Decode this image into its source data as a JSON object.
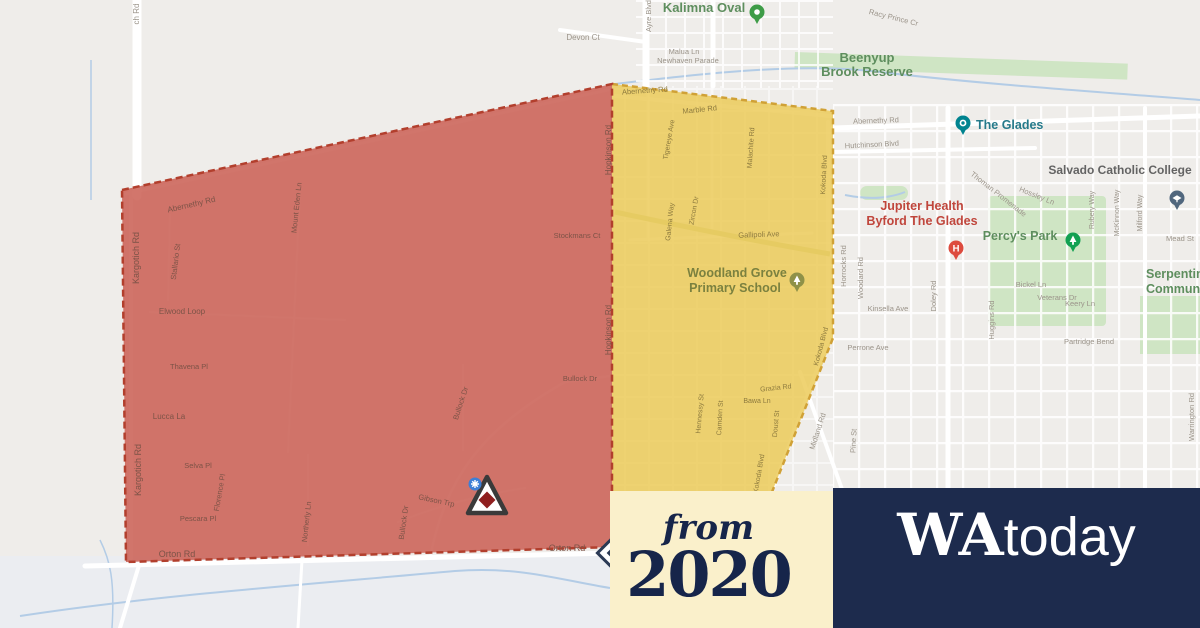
{
  "page": {
    "background": "#efedea"
  },
  "branding": {
    "from_label": "from",
    "year": "2020",
    "outlet_serif": "WA",
    "outlet_sans": "today",
    "badge_bg": "#faf0cb",
    "brand_bg": "#1d2b4d",
    "brand_text_navy": "#16254a"
  },
  "zones": {
    "red": {
      "label": "emergency-warning-zone",
      "fill": "rgba(201,92,80,0.84)",
      "border": "#b23f2d"
    },
    "yellow": {
      "label": "watch-and-act-zone",
      "fill": "rgba(236,201,84,0.82)",
      "border": "#d0a136"
    }
  },
  "map": {
    "labels": [
      {
        "t": "ch Rd",
        "x": 139,
        "y": 14,
        "r": -90,
        "s": 8
      },
      {
        "t": "Devon Ct",
        "x": 583,
        "y": 40,
        "s": 8
      },
      {
        "t": "Malua Ln",
        "x": 684,
        "y": 54,
        "s": 7.5
      },
      {
        "t": "Newhaven Parade",
        "x": 688,
        "y": 63,
        "s": 7.5
      },
      {
        "t": "Racy Prince Cr",
        "x": 893,
        "y": 20,
        "r": 14,
        "s": 7.5
      },
      {
        "t": "Ayre Blvd",
        "x": 651,
        "y": 16,
        "r": -90,
        "s": 7.5
      },
      {
        "t": "Abernethy Rd",
        "x": 876,
        "y": 123,
        "r": -2,
        "s": 7.5
      },
      {
        "t": "Hutchinson Blvd",
        "x": 872,
        "y": 147,
        "r": -3,
        "s": 7.5
      },
      {
        "t": "Thoman Promenade",
        "x": 997,
        "y": 196,
        "r": 38,
        "s": 7.5
      },
      {
        "t": "Hossley Ln",
        "x": 1036,
        "y": 198,
        "r": 22,
        "s": 7.5
      },
      {
        "t": "Mead St",
        "x": 1180,
        "y": 241,
        "s": 7.5
      },
      {
        "t": "Bickel Ln",
        "x": 1031,
        "y": 287,
        "s": 7.5
      },
      {
        "t": "Veterans Dr",
        "x": 1057,
        "y": 300,
        "s": 7.5
      },
      {
        "t": "Keery Ln",
        "x": 1080,
        "y": 306,
        "s": 7.5
      },
      {
        "t": "Partridge Bend",
        "x": 1089,
        "y": 344,
        "s": 7.5
      },
      {
        "t": "Kinsella Ave",
        "x": 888,
        "y": 311,
        "s": 7.5
      },
      {
        "t": "Perrone Ave",
        "x": 868,
        "y": 350,
        "s": 7.5
      },
      {
        "t": "Horrocks Rd",
        "x": 846,
        "y": 266,
        "r": -90,
        "s": 7.5
      },
      {
        "t": "Woodard Rd",
        "x": 863,
        "y": 278,
        "r": -90,
        "s": 7.5
      },
      {
        "t": "Doley Rd",
        "x": 936,
        "y": 296,
        "r": -90,
        "s": 7.5
      },
      {
        "t": "Huggins Rd",
        "x": 994,
        "y": 320,
        "r": -90,
        "s": 7.5
      },
      {
        "t": "Rubery Way",
        "x": 1094,
        "y": 210,
        "r": -90,
        "s": 7
      },
      {
        "t": "McKinnon Way",
        "x": 1119,
        "y": 213,
        "r": -90,
        "s": 7
      },
      {
        "t": "Milford Way",
        "x": 1142,
        "y": 213,
        "r": -90,
        "s": 7
      },
      {
        "t": "Warrington Rd",
        "x": 1194,
        "y": 417,
        "r": -90,
        "s": 7.5
      },
      {
        "t": "Midland Rd",
        "x": 820,
        "y": 432,
        "r": -72,
        "s": 7.5
      },
      {
        "t": "Pine St",
        "x": 856,
        "y": 441,
        "r": -87,
        "s": 7.5
      },
      {
        "t": "Kargotich Rd",
        "x": 139,
        "y": 258,
        "r": -90,
        "s": 9,
        "c": "street-red"
      },
      {
        "t": "Kargotich Rd",
        "x": 141,
        "y": 470,
        "r": -90,
        "s": 9,
        "c": "street-red"
      },
      {
        "t": "Abernethy Rd",
        "x": 192,
        "y": 207,
        "r": -13,
        "s": 8,
        "c": "street-red"
      },
      {
        "t": "Stallario St",
        "x": 178,
        "y": 262,
        "r": -83,
        "s": 7.5,
        "c": "street-red"
      },
      {
        "t": "Mount Eden Ln",
        "x": 299,
        "y": 208,
        "r": -84,
        "s": 7.5,
        "c": "street-red"
      },
      {
        "t": "Elwood Loop",
        "x": 182,
        "y": 314,
        "s": 8,
        "c": "street-red"
      },
      {
        "t": "Thavena Pl",
        "x": 189,
        "y": 369,
        "s": 7.5,
        "c": "street-red"
      },
      {
        "t": "Lucca La",
        "x": 169,
        "y": 419,
        "s": 8,
        "c": "street-red"
      },
      {
        "t": "Selva Pl",
        "x": 198,
        "y": 468,
        "s": 7.5,
        "c": "street-red"
      },
      {
        "t": "Florence Pl",
        "x": 222,
        "y": 493,
        "r": -80,
        "s": 7.5,
        "c": "street-red"
      },
      {
        "t": "Pescara Pl",
        "x": 198,
        "y": 521,
        "s": 7.5,
        "c": "street-red"
      },
      {
        "t": "Stockmans Ct",
        "x": 577,
        "y": 238,
        "s": 7.5,
        "c": "street-red"
      },
      {
        "t": "Bullock Dr",
        "x": 580,
        "y": 381,
        "s": 7.5,
        "c": "street-red"
      },
      {
        "t": "Bullock Dr",
        "x": 463,
        "y": 404,
        "r": -72,
        "s": 7.5,
        "c": "street-red"
      },
      {
        "t": "Bullock Dr",
        "x": 406,
        "y": 523,
        "r": -82,
        "s": 7.5,
        "c": "street-red"
      },
      {
        "t": "Gibson Trp",
        "x": 436,
        "y": 503,
        "r": 12,
        "s": 7.5,
        "c": "street-red"
      },
      {
        "t": "Northerly Ln",
        "x": 309,
        "y": 522,
        "r": -84,
        "s": 7.5,
        "c": "street-red"
      },
      {
        "t": "Orton Rd",
        "x": 177,
        "y": 557,
        "s": 9,
        "c": "street-red"
      },
      {
        "t": "Orton Rd",
        "x": 567,
        "y": 551,
        "s": 9,
        "c": "street-red"
      },
      {
        "t": "Hopkinson Rd",
        "x": 611,
        "y": 150,
        "r": -90,
        "s": 8,
        "c": "street-red"
      },
      {
        "t": "Hopkinson Rd",
        "x": 611,
        "y": 330,
        "r": -90,
        "s": 8,
        "c": "street-red"
      },
      {
        "t": "Abernethy Rd",
        "x": 645,
        "y": 93,
        "r": -4,
        "s": 7.5,
        "c": "street-yellow"
      },
      {
        "t": "Marble Rd",
        "x": 700,
        "y": 112,
        "r": -6,
        "s": 7.5,
        "c": "street-yellow"
      },
      {
        "t": "Tigereye Ave",
        "x": 671,
        "y": 140,
        "r": -80,
        "s": 7,
        "c": "street-yellow"
      },
      {
        "t": "Malachite Rd",
        "x": 753,
        "y": 148,
        "r": -86,
        "s": 7,
        "c": "street-yellow"
      },
      {
        "t": "Kokoda Blvd",
        "x": 826,
        "y": 175,
        "r": -87,
        "s": 7,
        "c": "street-yellow"
      },
      {
        "t": "Zircon Dr",
        "x": 696,
        "y": 211,
        "r": -80,
        "s": 7,
        "c": "street-yellow"
      },
      {
        "t": "Galena Way",
        "x": 672,
        "y": 222,
        "r": -84,
        "s": 7,
        "c": "street-yellow"
      },
      {
        "t": "Gallipoli Ave",
        "x": 759,
        "y": 237,
        "r": -2,
        "s": 7.5,
        "c": "street-yellow"
      },
      {
        "t": "Kokoda Blvd",
        "x": 823,
        "y": 347,
        "r": -75,
        "s": 7,
        "c": "street-yellow"
      },
      {
        "t": "Grazia Rd",
        "x": 776,
        "y": 390,
        "r": -6,
        "s": 7,
        "c": "street-yellow"
      },
      {
        "t": "Bawa Ln",
        "x": 757,
        "y": 403,
        "s": 7,
        "c": "street-yellow"
      },
      {
        "t": "Hennessy St",
        "x": 702,
        "y": 414,
        "r": -85,
        "s": 7,
        "c": "street-yellow"
      },
      {
        "t": "Camden St",
        "x": 722,
        "y": 418,
        "r": -87,
        "s": 7,
        "c": "street-yellow"
      },
      {
        "t": "Doust St",
        "x": 778,
        "y": 424,
        "r": -85,
        "s": 7,
        "c": "street-yellow"
      },
      {
        "t": "Kokoda Blvd",
        "x": 761,
        "y": 474,
        "r": -80,
        "s": 7,
        "c": "street-yellow"
      },
      {
        "t": "Kalimna Oval",
        "x": 704,
        "y": 12,
        "s": 13,
        "c": "area-green"
      },
      {
        "t": "Beenyup",
        "x": 867,
        "y": 62,
        "s": 13,
        "c": "area-green"
      },
      {
        "t": "Brook Reserve",
        "x": 867,
        "y": 76,
        "s": 13,
        "c": "area-green"
      },
      {
        "t": "Percy's Park",
        "x": 1020,
        "y": 240,
        "s": 12.5,
        "c": "area-green"
      },
      {
        "t": "Serpentine",
        "x": 1146,
        "y": 278,
        "s": 12.5,
        "a": "start",
        "c": "area-green"
      },
      {
        "t": "Community",
        "x": 1146,
        "y": 293,
        "s": 12.5,
        "a": "start",
        "c": "area-green"
      },
      {
        "t": "Woodland Grove",
        "x": 737,
        "y": 277,
        "s": 12.5,
        "c": "poi-olive"
      },
      {
        "t": "Primary School",
        "x": 735,
        "y": 292,
        "s": 12.5,
        "c": "poi-olive"
      },
      {
        "t": "The Glades",
        "x": 976,
        "y": 129,
        "s": 12.5,
        "a": "start",
        "c": "poi-teal"
      },
      {
        "t": "Salvado Catholic College",
        "x": 1120,
        "y": 174,
        "s": 12,
        "c": "poi-gray"
      },
      {
        "t": "Jupiter Health",
        "x": 922,
        "y": 210,
        "s": 12.5,
        "c": "poi-red"
      },
      {
        "t": "Byford The Glades",
        "x": 922,
        "y": 225,
        "s": 12.5,
        "c": "poi-red"
      }
    ],
    "pins": [
      {
        "n": "kalimna-oval-pin",
        "x": 757,
        "y": 22,
        "color": "#3e9c47",
        "glyph": "dot"
      },
      {
        "n": "the-glades-pin",
        "x": 963,
        "y": 133,
        "color": "#00838f",
        "glyph": "camera"
      },
      {
        "n": "salvado-college-pin",
        "x": 1177,
        "y": 208,
        "color": "#51677e",
        "glyph": "cap"
      },
      {
        "n": "jupiter-health-pin",
        "x": 956,
        "y": 258,
        "color": "#dd4b3e",
        "glyph": "H"
      },
      {
        "n": "percys-park-pin",
        "x": 1073,
        "y": 250,
        "color": "#12a152",
        "glyph": "tree"
      },
      {
        "n": "woodland-grove-school-pin",
        "x": 797,
        "y": 290,
        "color": "#8f9148",
        "glyph": "tree"
      }
    ],
    "icons": {
      "warning_triangle": "emergency-warning-icon",
      "warning_badge": "warning-gear-badge",
      "advice_diamond": "advice-diamond-icon"
    }
  }
}
